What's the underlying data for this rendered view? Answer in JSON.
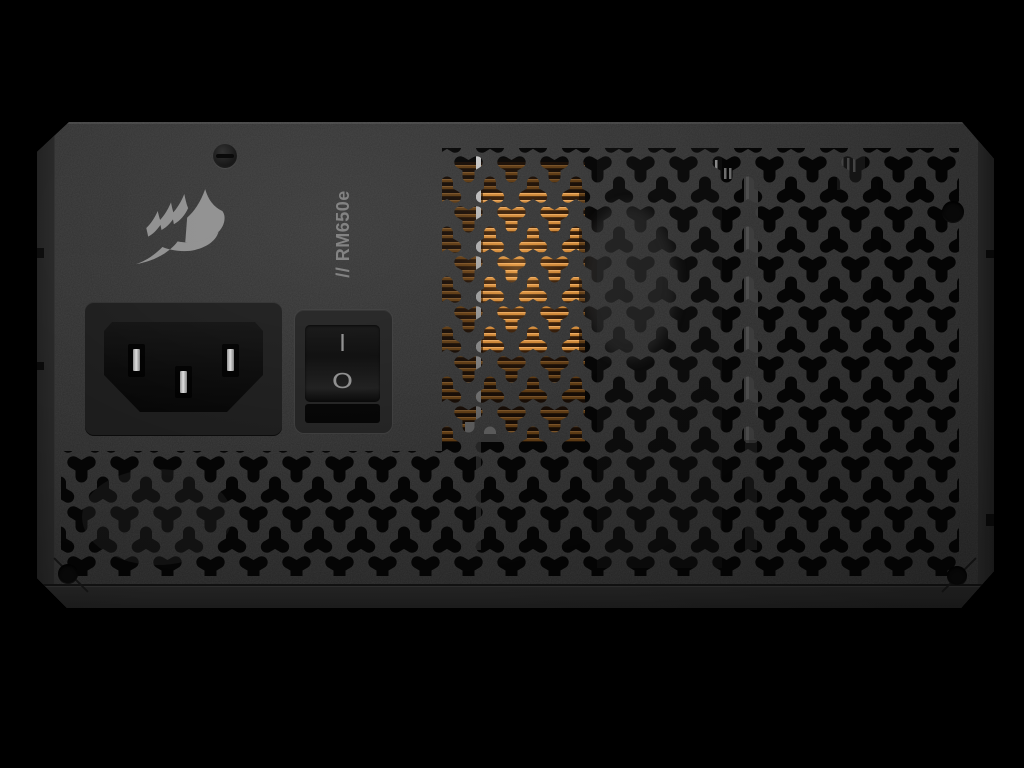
{
  "window": {
    "background": "#000000",
    "width": 1024,
    "height": 768
  },
  "psu": {
    "brand_logo_icon": "corsair-sails-icon",
    "model_label": "// RM650e",
    "power_switch": {
      "on_symbol": "I",
      "off_symbol": "O"
    },
    "ac_inlet": {
      "pin_count": 3
    },
    "colors": {
      "face": "#2e2e2e",
      "vent_hole": "#050505",
      "copper_heatsink_bright": "#d18a38",
      "copper_heatsink_dark": "#5a2f10",
      "logo_gray": "#8f8f8f",
      "label_gray": "#7d7d7d",
      "pin_silver": "#d6d6d6",
      "flange": "#242424"
    }
  }
}
